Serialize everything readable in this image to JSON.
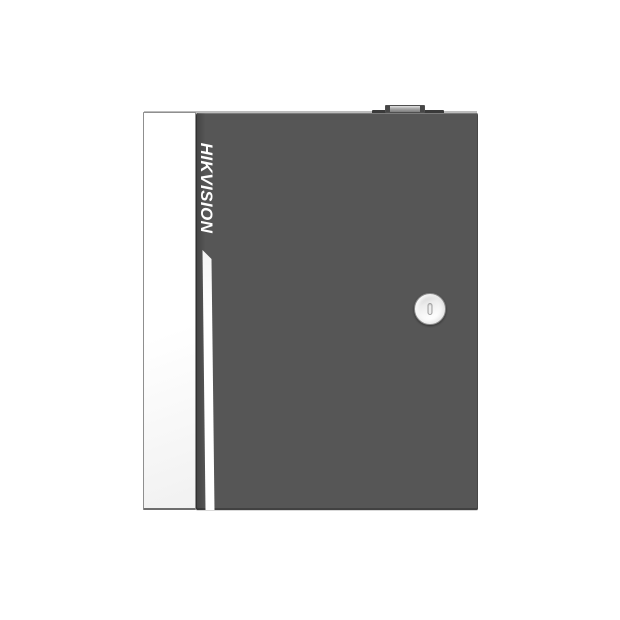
{
  "product": {
    "brand": "HIKVISION",
    "type": "Access control panel metal enclosure with key lock",
    "features": {
      "top_tab": "conduit knockout tab",
      "lock": "round cam lock with vertical keyhole slot",
      "stripe": "white accent stripe on door",
      "side": "white left side face"
    }
  },
  "colors": {
    "background": "#ffffff",
    "door_panel": "#565656",
    "door_edge_shadow": "#3f3f3f",
    "side_panel": "#fdfdfd",
    "side_panel_border": "#8f8f8f",
    "accent_stripe": "#ffffff",
    "brand_text": "#ffffff",
    "lock_face": "#f7f7f7",
    "lock_ring": "#898989",
    "top_tab_dark": "#3a3a3a",
    "top_tab_light": "#b5b5b5",
    "top_face_edge": "#bdbdbd"
  }
}
